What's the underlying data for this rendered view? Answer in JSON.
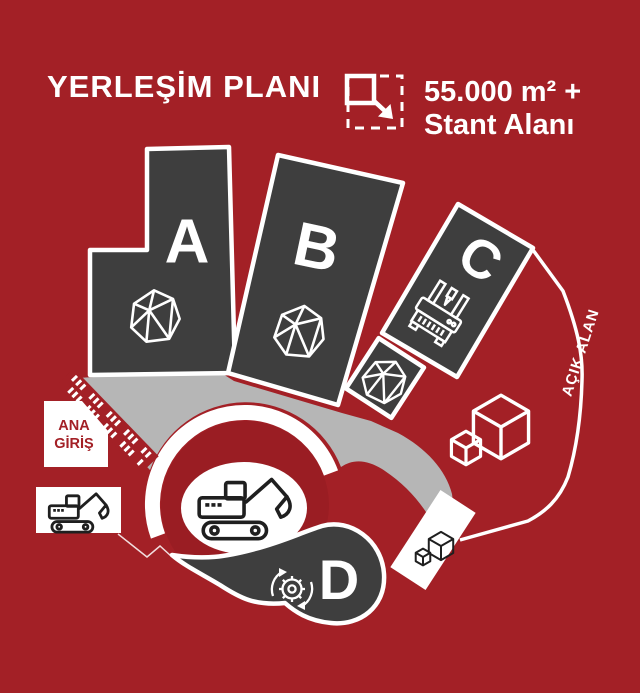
{
  "colors": {
    "bg": "#a32026",
    "hall": "#3e3e3e",
    "road": "#b6b6b6",
    "disc": "#9a1d23",
    "white": "#ffffff",
    "ink": "#1f1f1f"
  },
  "header": {
    "title": "YERLEŞİM PLANI",
    "legend": {
      "area_value": "55.000 m² +",
      "area_label": "Stant Alanı",
      "icon": "expand-area-icon"
    }
  },
  "halls": {
    "a": {
      "label": "A",
      "icon": "mineral-stone-icon"
    },
    "b": {
      "label": "B",
      "icon": "mineral-stone-icon"
    },
    "c": {
      "label": "C",
      "icon": "cnc-machine-icon"
    },
    "annex": {
      "icon": "mineral-stone-icon"
    },
    "d": {
      "label": "D",
      "icon": "recycling-gear-icon"
    }
  },
  "labels": {
    "main_entrance_line1": "ANA",
    "main_entrance_line2": "GİRİŞ",
    "open_area": "AÇIK ALAN"
  },
  "icons": {
    "center_roundabout": "excavator-icon",
    "left_stand": "excavator-icon",
    "open_area": "boxes-icon",
    "small_stand": "boxes-icon"
  }
}
